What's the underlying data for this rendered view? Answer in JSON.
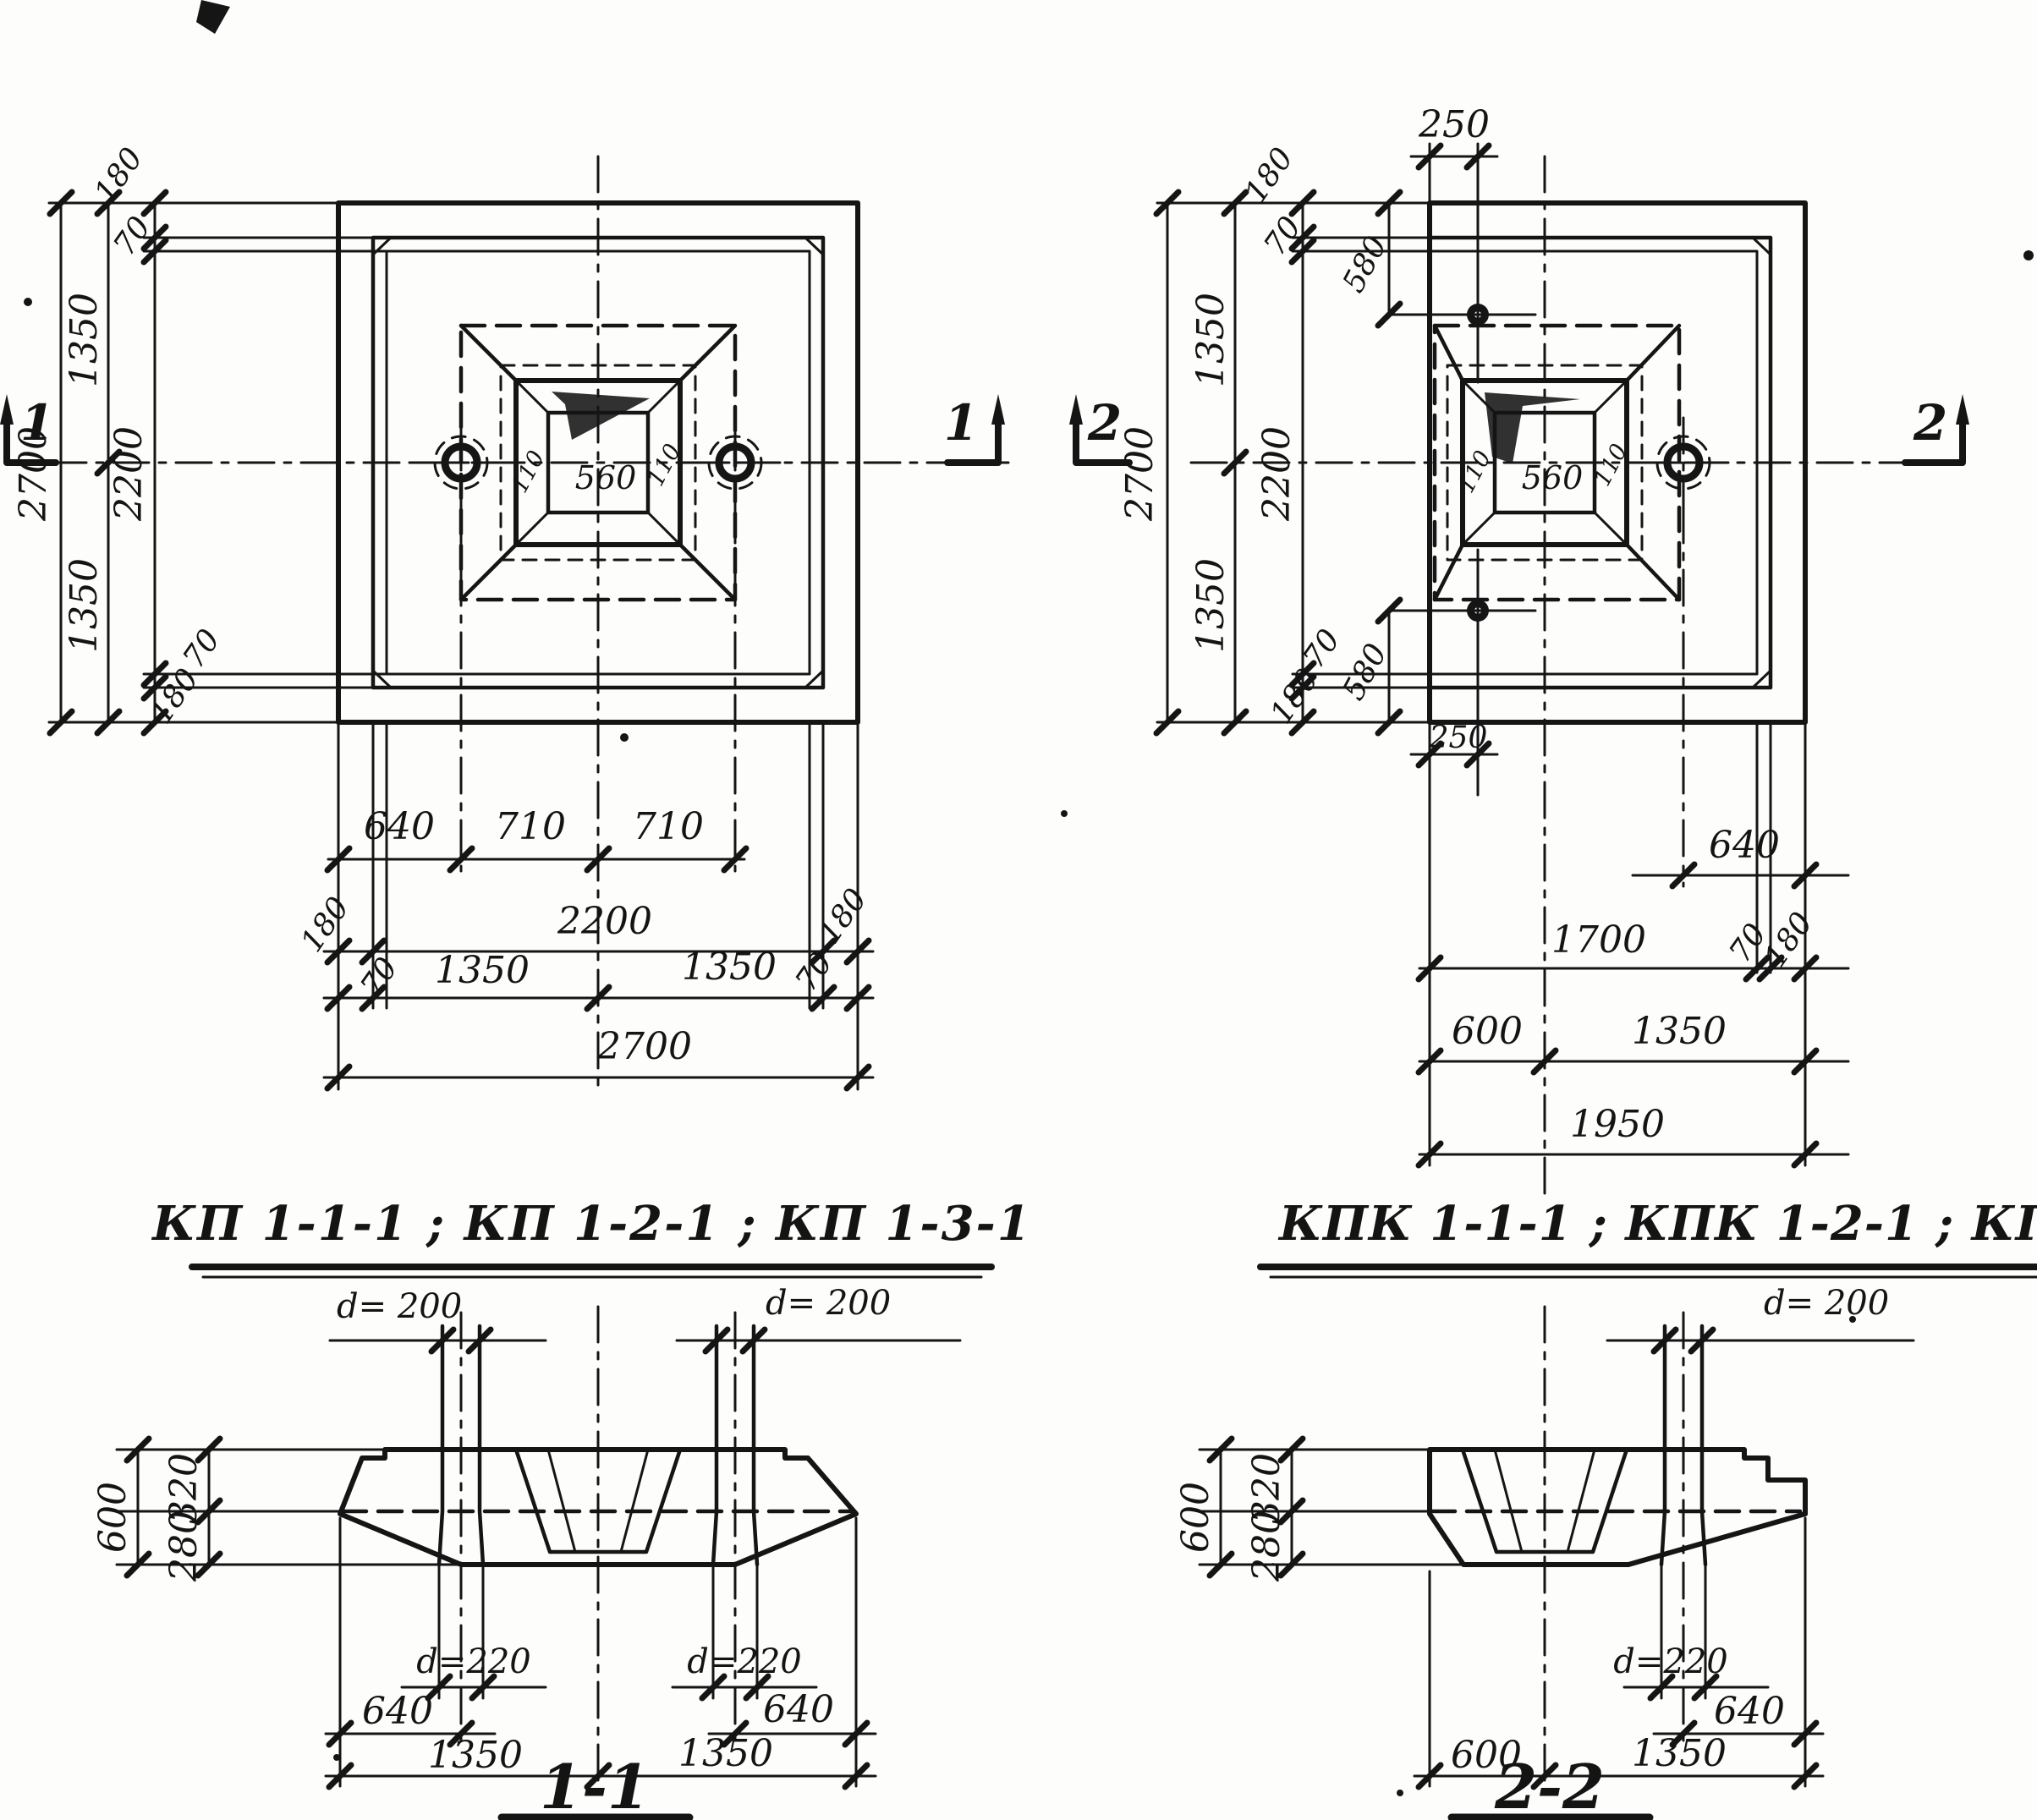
{
  "doc": {
    "title_left": "КП 1-1-1 ; КП 1-2-1 ; КП 1-3-1",
    "title_right": "КПК 1-1-1 ; КПК 1-2-1 ; КПК 1-3-1",
    "section1_title": "1-1",
    "section2_title": "2-2",
    "mark1": "1",
    "mark2": "2",
    "ink_color": "#151515",
    "paper_color": "#fdfdfc"
  },
  "planL": {
    "socket": "560",
    "wall_l": "110",
    "wall_r": "110",
    "v2700": "2700",
    "v1350t": "1350",
    "v1350b": "1350",
    "v2200": "2200",
    "v180t": "180",
    "v70t": "70",
    "v70b": "70",
    "v180b": "180",
    "b640": "640",
    "b710a": "710",
    "b710b": "710",
    "b180l": "180",
    "b2200": "2200",
    "b180r": "180",
    "b70l": "70",
    "b1350l": "1350",
    "b1350r": "1350",
    "b70r": "70",
    "b2700": "2700"
  },
  "planR": {
    "socket": "560",
    "wall_l": "110",
    "wall_r": "110",
    "t250": "250",
    "t580": "580",
    "v180t": "180",
    "v70t": "70",
    "v2700": "2700",
    "v1350t": "1350",
    "v1350b": "1350",
    "v2200": "2200",
    "b580": "580",
    "b250": "250",
    "v70b": "70",
    "v180b": "180",
    "r640": "640",
    "r1700": "1700",
    "r70": "70",
    "r180": "180",
    "r600": "600",
    "r1350": "1350",
    "r1950": "1950"
  },
  "sec1": {
    "d200l": "d= 200",
    "d200r": "d= 200",
    "d220l": "d=220",
    "d220r": "d=220",
    "h600": "600",
    "h320": "320",
    "h280": "280",
    "w640l": "640",
    "w640r": "640",
    "w1350l": "1350",
    "w1350r": "1350"
  },
  "sec2": {
    "d200": "d= 200",
    "d220": "d=220",
    "h600": "600",
    "h320": "320",
    "h280": "280",
    "w640": "640",
    "w600": "600",
    "w1350": "1350"
  }
}
